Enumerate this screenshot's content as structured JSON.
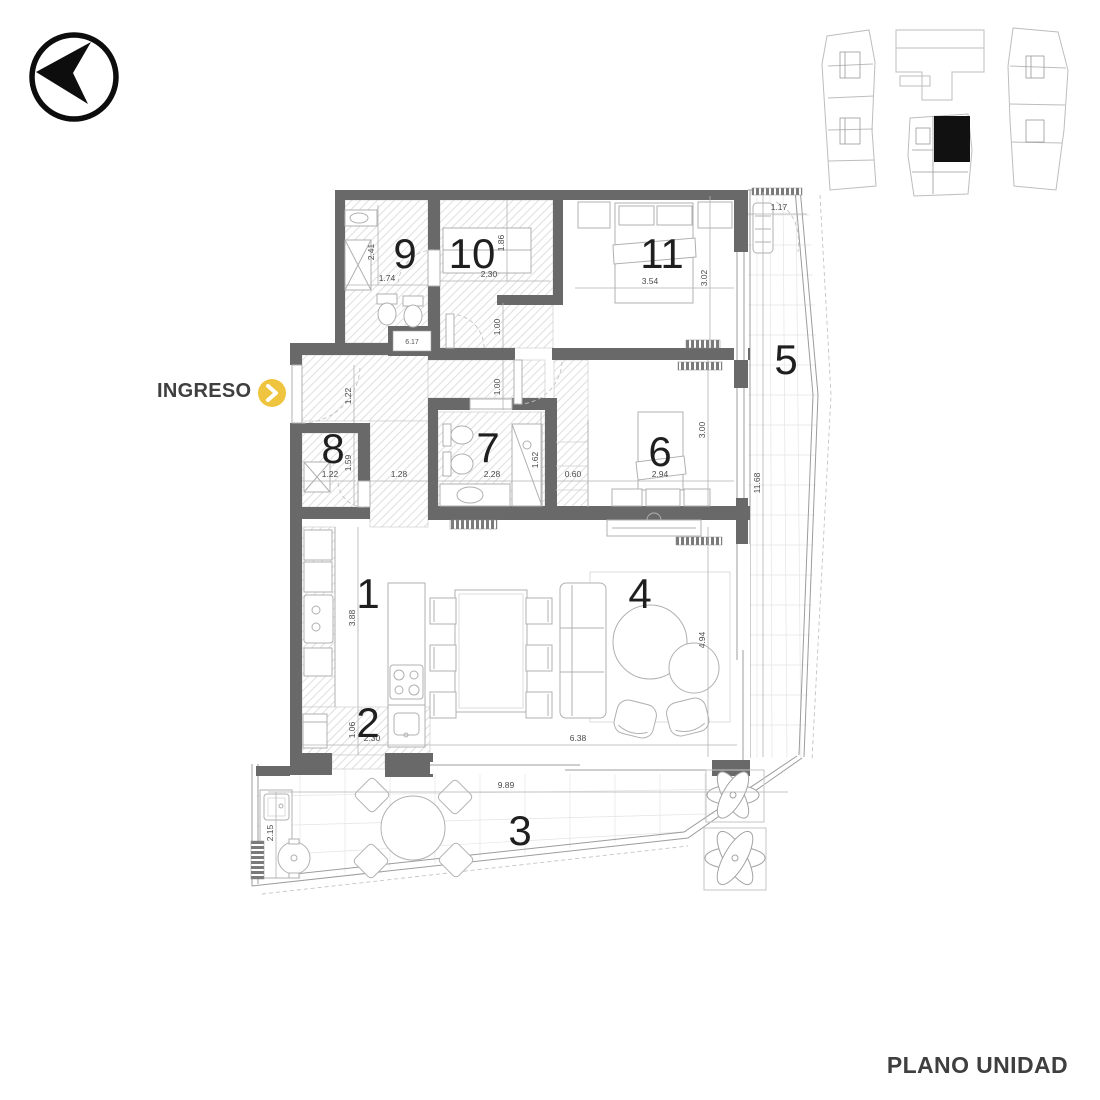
{
  "header": {
    "ingreso": "INGRESO",
    "title": "PLANO UNIDAD"
  },
  "colors": {
    "wall": "#696969",
    "accent_yellow": "#EFC43E",
    "label_text": "#3F3F3F",
    "furniture_line": "#B0B0B0",
    "hatch_line": "#D7D7D7",
    "unit_highlight": "#111111"
  },
  "rooms": [
    {
      "n": "1"
    },
    {
      "n": "2"
    },
    {
      "n": "3"
    },
    {
      "n": "4"
    },
    {
      "n": "5"
    },
    {
      "n": "6"
    },
    {
      "n": "7"
    },
    {
      "n": "8"
    },
    {
      "n": "9"
    },
    {
      "n": "10"
    },
    {
      "n": "11"
    }
  ],
  "dims": {
    "r9_h": "2.41",
    "r9_w": "1.74",
    "r10_w": "2.30",
    "r10_h": "1.86",
    "hall_1": "1.00",
    "hall_2": "1.00",
    "r11_w": "3.54",
    "r11_h": "3.02",
    "balc_w": "1.17",
    "balc_l": "11.68",
    "entry": "1.22",
    "r8_w": "1.22",
    "r8_h": "1.59",
    "pas": "1.28",
    "r7_w": "2.28",
    "r7_h": "1.62",
    "ward": "0.60",
    "r6_w": "2.94",
    "r6_h": "3.00",
    "kit_h": "3.88",
    "r2_h": "1.06",
    "r2_w": "2.30",
    "liv_w": "6.38",
    "liv_h": "4.94",
    "ter_w": "9.89",
    "ter_l": "2.15",
    "shaft": "6.17"
  }
}
